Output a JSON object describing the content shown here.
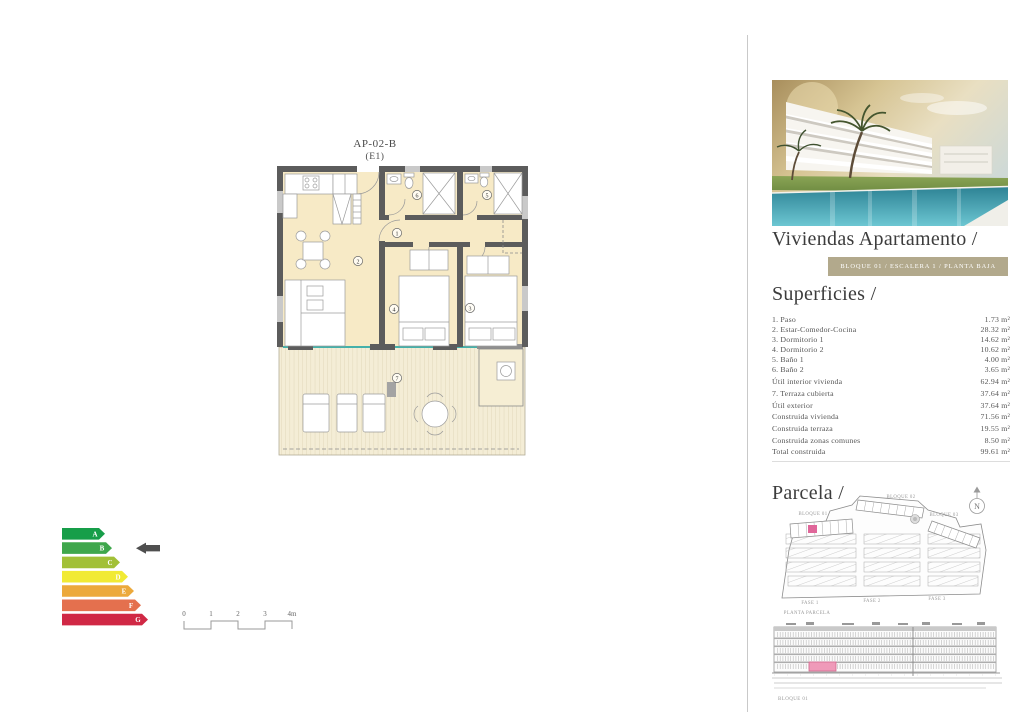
{
  "colors": {
    "accent_badge": "#b2a98c",
    "highlight_pink": "#e0679a",
    "elevation_highlight": "#ef9ab9",
    "plan_room_fill": "#f7eac6",
    "plan_wall": "#5c5c5c",
    "glass_teal": "#45b1aa"
  },
  "plan": {
    "title": "AP-02-B",
    "subtitle": "(E1)",
    "rooms": [
      "1",
      "2",
      "3",
      "4",
      "5",
      "6",
      "7"
    ]
  },
  "energy_label": {
    "current": "B",
    "ratings": [
      {
        "letter": "A",
        "color": "#179e49"
      },
      {
        "letter": "B",
        "color": "#3fa74c"
      },
      {
        "letter": "C",
        "color": "#a2c037"
      },
      {
        "letter": "D",
        "color": "#f1ea34"
      },
      {
        "letter": "E",
        "color": "#eca93b"
      },
      {
        "letter": "F",
        "color": "#e4704e"
      },
      {
        "letter": "G",
        "color": "#d02845"
      }
    ]
  },
  "scale_bar": {
    "ticks": [
      "0",
      "1",
      "2",
      "3",
      "4m"
    ]
  },
  "right_panel": {
    "title": "Viviendas Apartamento /",
    "badge": "BLOQUE 01 / ESCALERA 1 / PLANTA BAJA",
    "superficies": {
      "heading": "Superficies /",
      "rows": [
        {
          "label": "1. Paso",
          "value": "1.73 m²"
        },
        {
          "label": "2. Estar-Comedor-Cocina",
          "value": "28.32 m²"
        },
        {
          "label": "3. Dormitorio 1",
          "value": "14.62 m²"
        },
        {
          "label": "4. Dormitorio 2",
          "value": "10.62 m²"
        },
        {
          "label": "5. Baño 1",
          "value": "4.00 m²"
        },
        {
          "label": "6. Baño 2",
          "value": "3.65 m²"
        },
        {
          "label": "Útil interior vivienda",
          "value": "62.94 m²"
        },
        {
          "label": "7. Terraza cubierta",
          "value": "37.64 m²"
        },
        {
          "label": "Útil exterior",
          "value": "37.64 m²"
        },
        {
          "label": "Construida vivienda",
          "value": "71.56 m²"
        },
        {
          "label": "Construida terraza",
          "value": "19.55 m²"
        },
        {
          "label": "Construida zonas comunes",
          "value": "8.50 m²"
        },
        {
          "label": "Total construida",
          "value": "99.61 m²"
        }
      ]
    },
    "parcela": {
      "heading": "Parcela /",
      "bloque01": "BLOQUE 01",
      "bloque02": "BLOQUE 02",
      "bloque03": "BLOQUE 03",
      "fase1": "FASE 1",
      "fase2": "FASE 2",
      "fase3": "FASE 3",
      "planta": "PLANTA PARCELA",
      "north": "N"
    },
    "elevation": {
      "label": "BLOQUE 01"
    }
  }
}
